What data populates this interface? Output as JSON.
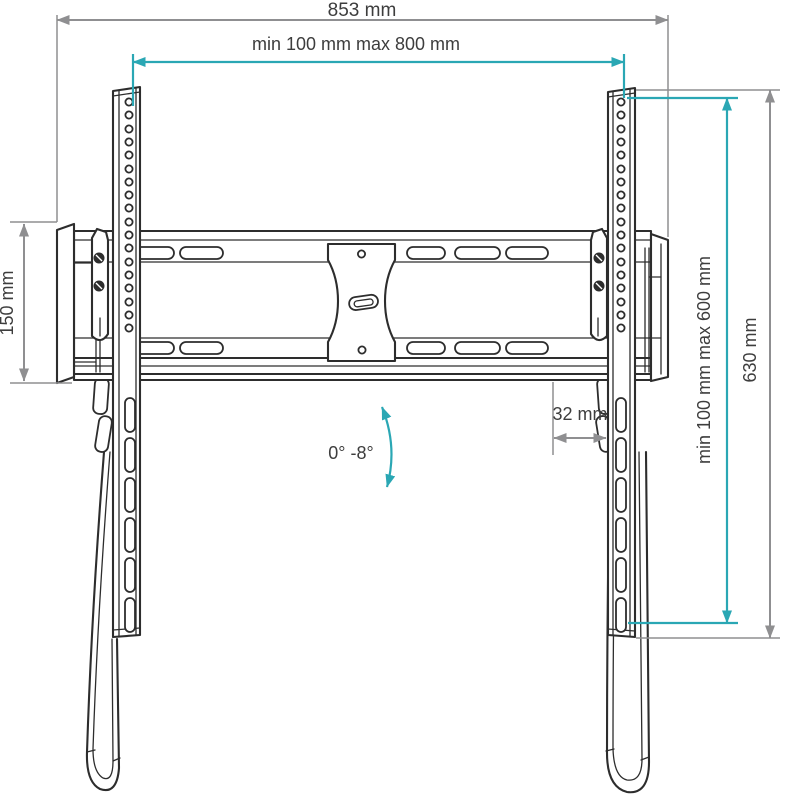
{
  "diagram": {
    "type": "technical-dimension-drawing",
    "subject": "Tilting TV wall mount bracket, front view with dimensions",
    "background": "#ffffff",
    "colors": {
      "drawing_line": "#2d2d2d",
      "dimension_gray": "#8f8f91",
      "dimension_teal": "#2aa7b4",
      "label_text": "#3d3d3d"
    },
    "labels": {
      "total_width": "853 mm",
      "mount_width_range": "min 100 mm max 800 mm",
      "wall_plate_height": "150 mm",
      "mount_height_range": "min 100 mm max 600 mm",
      "bracket_height": "630 mm",
      "depth_offset": "32 mm",
      "tilt_range": "0° -8°"
    }
  }
}
